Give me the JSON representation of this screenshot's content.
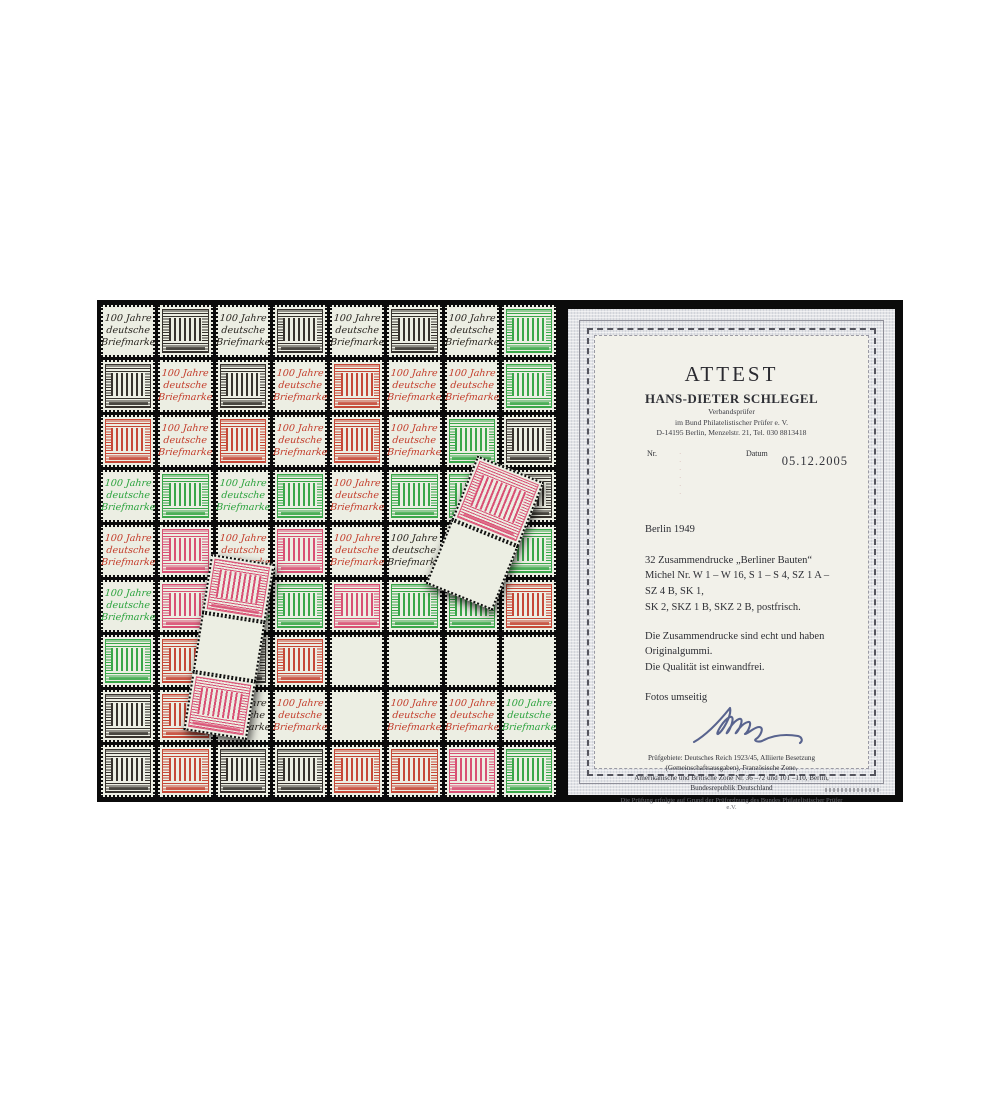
{
  "stamps": {
    "label_lines": [
      "100 Jahre",
      "deutsche",
      "Briefmarke"
    ],
    "palette": {
      "paper": "#eceee3",
      "black": "#27231e",
      "red": "#c33b29",
      "green": "#2aa23c",
      "pink": "#d8436b",
      "background": "#0b0b0b"
    },
    "grid": [
      [
        "Lk",
        "Sk",
        "Lk",
        "Sk",
        "Lk",
        "Sk",
        "Lk",
        "Sg"
      ],
      [
        "Sk",
        "Lr",
        "Sk",
        "Lr",
        "Sr",
        "Lr",
        "Lr",
        "Sg"
      ],
      [
        "Sr",
        "Lr",
        "Sr",
        "Lr",
        "Sr",
        "Lr",
        "Sg",
        "Sk"
      ],
      [
        "Lg",
        "Sg",
        "Lg",
        "Sg",
        "Lr",
        "Sg",
        "Sg",
        "Sk"
      ],
      [
        "Lr",
        "Sp",
        "Lr",
        "Sp",
        "Lr",
        "Lk",
        "Sg",
        "Sg"
      ],
      [
        "Lg",
        "Sp",
        "Lg",
        "Sg",
        "Sp",
        "Sg",
        "Sg",
        "Sr"
      ],
      [
        "Sg",
        "Sr",
        "Sk",
        "Sr",
        "B",
        "B",
        "B",
        "B"
      ],
      [
        "Sk",
        "Sr",
        "Lk",
        "Lr",
        "B",
        "Lr",
        "Lr",
        "Lg"
      ],
      [
        "Sk",
        "Sr",
        "Sk",
        "Sk",
        "Sr",
        "Sr",
        "Sp",
        "Sg"
      ]
    ],
    "loose_strips": [
      {
        "id": "strip-a",
        "cells": [
          "Sp",
          "B",
          "Sp"
        ]
      },
      {
        "id": "strip-b",
        "cells": [
          "Sp",
          "B"
        ]
      }
    ]
  },
  "certificate": {
    "title": "ATTEST",
    "examiner": "HANS-DIETER SCHLEGEL",
    "role": "Verbandsprüfer",
    "association": "im Bund Philatelistischer Prüfer e. V.",
    "address": "D-14195 Berlin, Menzelstr. 21, Tel. 030 8813418",
    "nr_label": "Nr.",
    "nr_value_faint": "· · · · · ·",
    "datum_label": "Datum",
    "date": "05.12.2005",
    "item_heading": "Berlin 1949",
    "description_lines": [
      "32 Zusammendrucke „Berliner Bauten“",
      "Michel Nr. W 1 – W 16, S 1 – S 4, SZ 1 A – SZ 4 B, SK 1,",
      "SK 2, SKZ 1 B, SKZ 2 B, postfrisch."
    ],
    "verdict_lines": [
      "Die Zusammendrucke sind echt und haben Originalgummi.",
      "Die Qualität ist einwandfrei."
    ],
    "photos_note": "Fotos umseitig",
    "signature_ink_color": "#3d4a7e",
    "footer_lines": [
      "Prüfgebiete: Deutsches Reich 1923/45, Alliierte Besetzung (Gemeinschaftsausgaben), Französische Zone,",
      "Amerikanische und Britische Zone Nr. 36 –72 und 101 –110, Berlin, Bundesrepublik Deutschland"
    ],
    "footer_small": "Die Prüfung erfolgte auf Grund der Prüfordnung des Bundes Philatelistischer Prüfer e.V."
  }
}
